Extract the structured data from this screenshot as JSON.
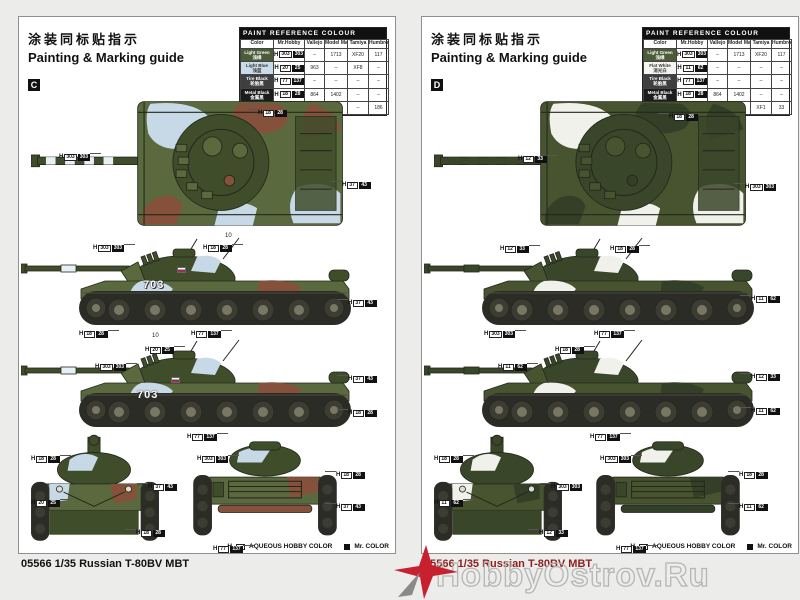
{
  "watermark": {
    "text": "HobbyOstrov.Ru"
  },
  "pages": [
    {
      "letter": "C",
      "header": {
        "title_zh": "涂装同标贴指示",
        "title_en": "Painting & Marking guide"
      },
      "model_name": "05566 1/35 Russian T-80BV MBT",
      "legend": {
        "aqueous": "AQUEOUS HOBBY COLOR",
        "mr_color": "Mr. COLOR",
        "h_prefix": "H"
      },
      "turret_number": "703",
      "palette": {
        "base": "#5a6a3e",
        "p1": "#c7d9e6",
        "p2": "#85513a",
        "dk": "#3f4d2b",
        "stripe": "#e8f0f4"
      },
      "paint_table": {
        "title": "PAINT REFERENCE COLOUR",
        "columns": [
          "Color",
          "Mr.Hobby",
          "Vallejo",
          "Model Master",
          "Tamiya",
          "Humbrol"
        ],
        "rows": [
          {
            "name_en": "Light Green",
            "name_zh": "浅绿",
            "swatch": "#4c5b38",
            "text": "#ffffff",
            "aq": "303",
            "mr": "303",
            "vallejo": "–",
            "mm": "1713",
            "tamiya": "XF20",
            "humbrol": "117"
          },
          {
            "name_en": "Light Blue",
            "name_zh": "浅蓝",
            "swatch": "#c9dcea",
            "text": "#333333",
            "aq": "20",
            "mr": "25",
            "vallejo": "963",
            "mm": "–",
            "tamiya": "XF8",
            "humbrol": "–"
          },
          {
            "name_en": "Tire Black",
            "name_zh": "轮胎黑",
            "swatch": "#3f3f3f",
            "text": "#ffffff",
            "aq": "77",
            "mr": "137",
            "vallejo": "–",
            "mm": "–",
            "tamiya": "–",
            "humbrol": "–"
          },
          {
            "name_en": "Metal Black",
            "name_zh": "金属黑",
            "swatch": "#1c1c1c",
            "text": "#ffffff",
            "aq": "18",
            "mr": "28",
            "vallejo": "864",
            "mm": "1402",
            "tamiya": "–",
            "humbrol": "–"
          },
          {
            "name_en": "Wood Brown",
            "name_zh": "木棕色",
            "swatch": "#7d4a35",
            "text": "#ffffff",
            "aq": "37",
            "mr": "43",
            "vallejo": "983",
            "mm": "1701",
            "tamiya": "–",
            "humbrol": "186"
          }
        ]
      },
      "callouts": [
        {
          "x": 40,
          "y": 128,
          "aq": "303",
          "mr": "303",
          "side": "r"
        },
        {
          "x": 228,
          "y": 84,
          "aq": "18",
          "mr": "28",
          "side": "l"
        },
        {
          "x": 312,
          "y": 156,
          "aq": "37",
          "mr": "43",
          "side": "l"
        },
        {
          "x": 74,
          "y": 219,
          "aq": "303",
          "mr": "303",
          "side": "r"
        },
        {
          "x": 184,
          "y": 219,
          "aq": "18",
          "mr": "28",
          "side": "r"
        },
        {
          "x": 318,
          "y": 274,
          "aq": "37",
          "mr": "43",
          "side": "l"
        },
        {
          "x": 60,
          "y": 305,
          "aq": "18",
          "mr": "28",
          "side": "r"
        },
        {
          "x": 172,
          "y": 305,
          "aq": "77",
          "mr": "137",
          "side": "r"
        },
        {
          "x": 126,
          "y": 321,
          "aq": "20",
          "mr": "25",
          "side": "r"
        },
        {
          "x": 76,
          "y": 338,
          "aq": "303",
          "mr": "303",
          "side": "r"
        },
        {
          "x": 318,
          "y": 350,
          "aq": "37",
          "mr": "43",
          "side": "l"
        },
        {
          "x": 318,
          "y": 384,
          "aq": "18",
          "mr": "28",
          "side": "l"
        },
        {
          "x": 168,
          "y": 408,
          "aq": "77",
          "mr": "137",
          "side": "r"
        },
        {
          "x": 12,
          "y": 430,
          "aq": "18",
          "mr": "28",
          "side": "r"
        },
        {
          "x": 12,
          "y": 474,
          "aq": "20",
          "mr": "25",
          "side": "r"
        },
        {
          "x": 118,
          "y": 458,
          "aq": "37",
          "mr": "43",
          "side": "l"
        },
        {
          "x": 106,
          "y": 504,
          "aq": "18",
          "mr": "28",
          "side": "l"
        },
        {
          "x": 178,
          "y": 430,
          "aq": "303",
          "mr": "303",
          "side": "r"
        },
        {
          "x": 306,
          "y": 446,
          "aq": "18",
          "mr": "28",
          "side": "l"
        },
        {
          "x": 306,
          "y": 478,
          "aq": "37",
          "mr": "43",
          "side": "l"
        },
        {
          "x": 194,
          "y": 520,
          "aq": "77",
          "mr": "137",
          "side": "r"
        }
      ],
      "tiny_labels": [
        {
          "x": 206,
          "y": 216,
          "text": "10"
        },
        {
          "x": 133,
          "y": 316,
          "text": "10"
        }
      ],
      "decals": [
        {
          "type": "number",
          "x": 124,
          "y": 262
        },
        {
          "type": "number",
          "x": 118,
          "y": 372
        },
        {
          "type": "flag",
          "x": 158,
          "y": 250
        },
        {
          "type": "flag",
          "x": 152,
          "y": 360
        }
      ]
    },
    {
      "letter": "D",
      "header": {
        "title_zh": "涂装同标贴指示",
        "title_en": "Painting & Marking guide"
      },
      "model_name": "05566 1/35 Russian T-80BV MBT",
      "legend": {
        "aqueous": "AQUEOUS HOBBY COLOR",
        "mr_color": "Mr. COLOR",
        "h_prefix": "H"
      },
      "turret_number": "",
      "palette": {
        "base": "#47542f",
        "p1": "#f1f1ec",
        "p2": "#333f26",
        "dk": "#39462a",
        "stripe": "#39462a"
      },
      "paint_table": {
        "title": "PAINT REFERENCE COLOUR",
        "columns": [
          "Color",
          "Mr.Hobby",
          "Vallejo",
          "Model Master",
          "Tamiya",
          "Humbrol"
        ],
        "rows": [
          {
            "name_en": "Light Green",
            "name_zh": "浅绿",
            "swatch": "#4c5b38",
            "text": "#ffffff",
            "aq": "303",
            "mr": "303",
            "vallejo": "–",
            "mm": "1713",
            "tamiya": "XF20",
            "humbrol": "117"
          },
          {
            "name_en": "Flat White",
            "name_zh": "消光白",
            "swatch": "#f5f5f2",
            "text": "#333333",
            "aq": "11",
            "mr": "62",
            "vallejo": "–",
            "mm": "–",
            "tamiya": "–",
            "humbrol": "–"
          },
          {
            "name_en": "Tire Black",
            "name_zh": "轮胎黑",
            "swatch": "#3f3f3f",
            "text": "#ffffff",
            "aq": "77",
            "mr": "137",
            "vallejo": "–",
            "mm": "–",
            "tamiya": "–",
            "humbrol": "–"
          },
          {
            "name_en": "Metal Black",
            "name_zh": "金属黑",
            "swatch": "#1c1c1c",
            "text": "#ffffff",
            "aq": "18",
            "mr": "28",
            "vallejo": "864",
            "mm": "1402",
            "tamiya": "–",
            "humbrol": "–"
          },
          {
            "name_en": "Flat Black",
            "name_zh": "消光黑",
            "swatch": "#141414",
            "text": "#ffffff",
            "aq": "12",
            "mr": "33",
            "vallejo": "950",
            "mm": "1749",
            "tamiya": "XF1",
            "humbrol": "33"
          }
        ]
      },
      "callouts": [
        {
          "x": 96,
          "y": 130,
          "aq": "12",
          "mr": "33",
          "side": "r"
        },
        {
          "x": 236,
          "y": 88,
          "aq": "18",
          "mr": "28",
          "side": "l"
        },
        {
          "x": 312,
          "y": 158,
          "aq": "303",
          "mr": "303",
          "side": "l"
        },
        {
          "x": 78,
          "y": 220,
          "aq": "12",
          "mr": "33",
          "side": "r"
        },
        {
          "x": 188,
          "y": 220,
          "aq": "18",
          "mr": "28",
          "side": "r"
        },
        {
          "x": 318,
          "y": 270,
          "aq": "11",
          "mr": "62",
          "side": "l"
        },
        {
          "x": 62,
          "y": 305,
          "aq": "303",
          "mr": "303",
          "side": "r"
        },
        {
          "x": 172,
          "y": 305,
          "aq": "77",
          "mr": "137",
          "side": "r"
        },
        {
          "x": 76,
          "y": 338,
          "aq": "11",
          "mr": "62",
          "side": "r"
        },
        {
          "x": 133,
          "y": 321,
          "aq": "18",
          "mr": "28",
          "side": "r"
        },
        {
          "x": 318,
          "y": 348,
          "aq": "12",
          "mr": "33",
          "side": "l"
        },
        {
          "x": 318,
          "y": 382,
          "aq": "11",
          "mr": "62",
          "side": "l"
        },
        {
          "x": 168,
          "y": 408,
          "aq": "77",
          "mr": "137",
          "side": "r"
        },
        {
          "x": 12,
          "y": 430,
          "aq": "18",
          "mr": "28",
          "side": "r"
        },
        {
          "x": 12,
          "y": 474,
          "aq": "11",
          "mr": "62",
          "side": "r"
        },
        {
          "x": 118,
          "y": 458,
          "aq": "303",
          "mr": "303",
          "side": "l"
        },
        {
          "x": 106,
          "y": 504,
          "aq": "12",
          "mr": "33",
          "side": "l"
        },
        {
          "x": 178,
          "y": 430,
          "aq": "303",
          "mr": "303",
          "side": "r"
        },
        {
          "x": 306,
          "y": 446,
          "aq": "18",
          "mr": "28",
          "side": "l"
        },
        {
          "x": 306,
          "y": 478,
          "aq": "11",
          "mr": "62",
          "side": "l"
        },
        {
          "x": 194,
          "y": 520,
          "aq": "77",
          "mr": "137",
          "side": "r"
        }
      ],
      "tiny_labels": [],
      "decals": []
    }
  ]
}
